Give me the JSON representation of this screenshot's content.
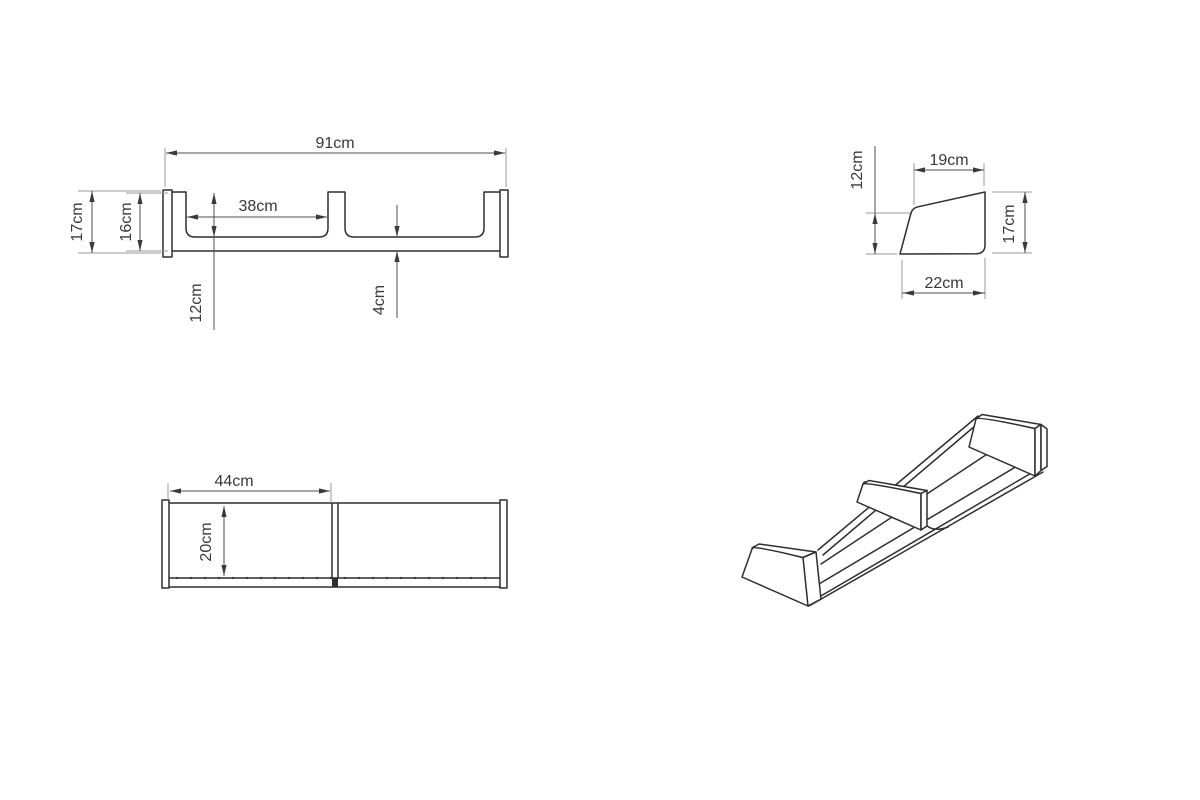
{
  "drawing": {
    "type": "technical-drawing",
    "unit": "cm",
    "front": {
      "labels": {
        "width": "91cm",
        "outer_height": "17cm",
        "body_height": "16cm",
        "compartment_width": "38cm",
        "inner_depth": "12cm",
        "base_thickness": "4cm"
      }
    },
    "side": {
      "labels": {
        "top_width": "19cm",
        "front_height": "12cm",
        "back_height": "17cm",
        "bottom_width": "22cm"
      }
    },
    "top": {
      "labels": {
        "compartment_width": "44cm",
        "depth": "20cm"
      }
    },
    "colors": {
      "background": "#ffffff",
      "part_line": "#2e2e2e",
      "dimension_line": "#4d4d4d",
      "extension_line": "#9a9a9a",
      "text": "#383838"
    }
  }
}
